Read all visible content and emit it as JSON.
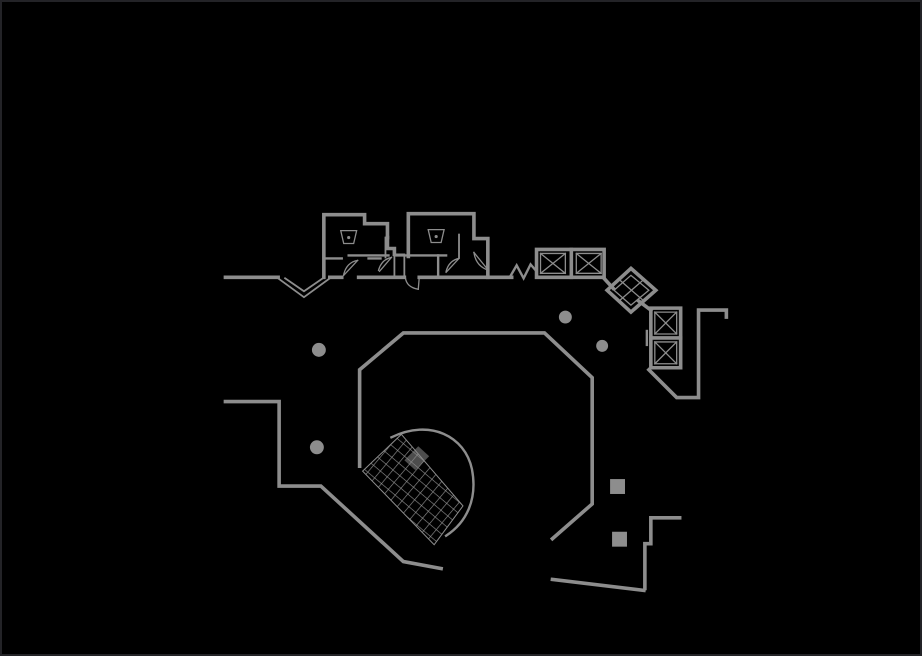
{
  "page": {
    "type": "cad-floor-plan-view",
    "background_color": "#000000",
    "frame_color": "#232327"
  },
  "drawing": {
    "kind": "architectural floor plan line drawing (building core with atrium)",
    "line_color": "#8d8d8d",
    "visible_text": "",
    "elements": {
      "restroom_rooms": 2,
      "toilet_fixture_symbols": 2,
      "elevator_cells_top_bank": 2,
      "elevator_cells_rotated": 1,
      "elevator_cells_right_bank": 2,
      "fan_stairs": 1,
      "round_columns": 4,
      "square_columns": 2,
      "door_swings": 5,
      "entry_notch": 1,
      "wall_break_symbol": 1
    }
  }
}
